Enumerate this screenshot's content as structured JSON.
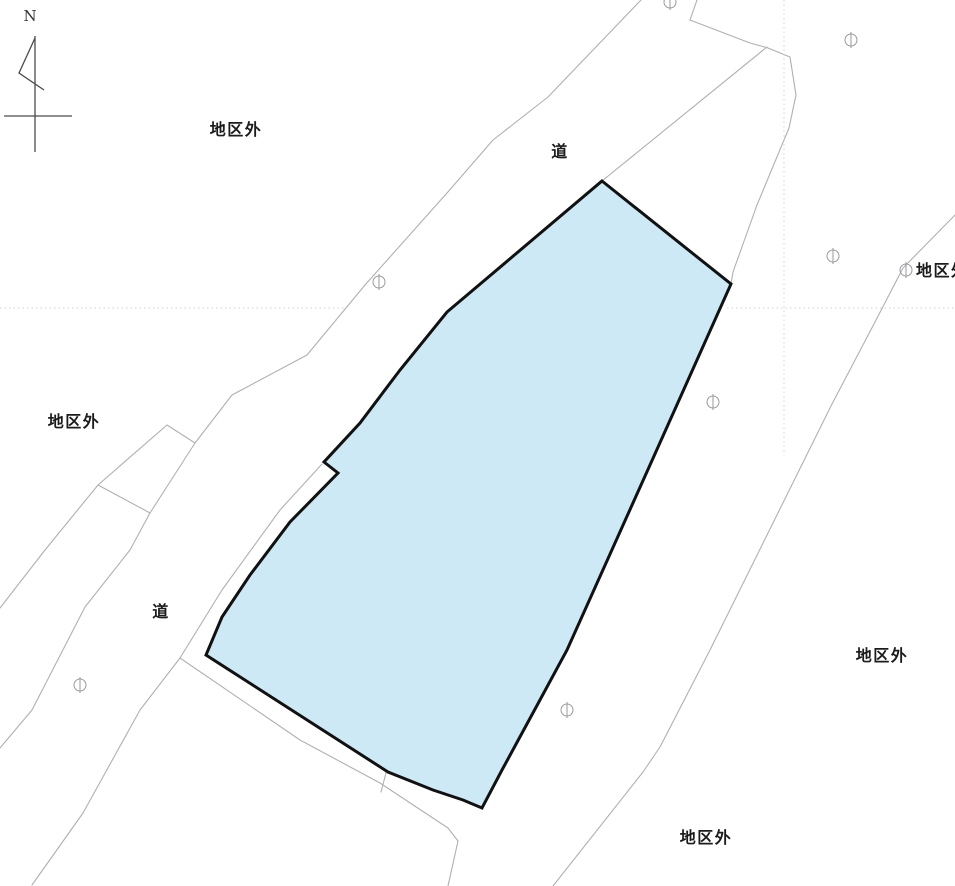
{
  "map": {
    "title": "cadastral district map",
    "north_label": "N",
    "labels": [
      {
        "text": "地区外",
        "x": 236,
        "y": 128,
        "anchor": "center"
      },
      {
        "text": "道",
        "x": 560,
        "y": 150,
        "anchor": "center"
      },
      {
        "text": "地区外",
        "x": 74,
        "y": 420,
        "anchor": "center"
      },
      {
        "text": "道",
        "x": 161,
        "y": 610,
        "anchor": "center"
      },
      {
        "text": "地区外",
        "x": 882,
        "y": 654,
        "anchor": "center"
      },
      {
        "text": "地区外",
        "x": 706,
        "y": 836,
        "anchor": "center"
      },
      {
        "text": "地区外",
        "x": 916,
        "y": 269,
        "anchor": "left"
      }
    ],
    "markers": {
      "symbol": "①",
      "color": "#9a9aa0",
      "points": [
        {
          "x": 670,
          "y": 2
        },
        {
          "x": 851,
          "y": 40
        },
        {
          "x": 833,
          "y": 256
        },
        {
          "x": 906,
          "y": 270
        },
        {
          "x": 379,
          "y": 282
        },
        {
          "x": 713,
          "y": 402
        },
        {
          "x": 80,
          "y": 685
        },
        {
          "x": 567,
          "y": 710
        }
      ]
    },
    "parcel": {
      "name": "highlighted district parcel",
      "fill": "#cde9f6",
      "stroke": "#111111",
      "stroke_width": 3,
      "points": [
        [
          602,
          181
        ],
        [
          731,
          284
        ],
        [
          650,
          465
        ],
        [
          567,
          650
        ],
        [
          534,
          711
        ],
        [
          502,
          770
        ],
        [
          482,
          808
        ],
        [
          463,
          800
        ],
        [
          433,
          790
        ],
        [
          388,
          772
        ],
        [
          206,
          655
        ],
        [
          222,
          617
        ],
        [
          250,
          575
        ],
        [
          290,
          522
        ],
        [
          338,
          473
        ],
        [
          324,
          462
        ],
        [
          360,
          423
        ],
        [
          400,
          370
        ],
        [
          447,
          312
        ]
      ]
    },
    "boundary_lines": {
      "color": "#b0b0b4",
      "solid": [
        [
          [
            641,
            0
          ],
          [
            548,
            97
          ],
          [
            493,
            140
          ],
          [
            447,
            193
          ],
          [
            365,
            285
          ],
          [
            307,
            355
          ],
          [
            232,
            395
          ],
          [
            195,
            443
          ],
          [
            150,
            513
          ],
          [
            130,
            550
          ],
          [
            85,
            607
          ],
          [
            32,
            710
          ],
          [
            0,
            748
          ]
        ],
        [
          [
            195,
            443
          ],
          [
            167,
            425
          ],
          [
            98,
            485
          ],
          [
            150,
            513
          ]
        ],
        [
          [
            98,
            485
          ],
          [
            45,
            550
          ],
          [
            0,
            608
          ]
        ],
        [
          [
            322,
            464
          ],
          [
            280,
            510
          ],
          [
            222,
            590
          ],
          [
            180,
            658
          ]
        ],
        [
          [
            180,
            658
          ],
          [
            140,
            710
          ],
          [
            83,
            813
          ],
          [
            32,
            885
          ]
        ],
        [
          [
            180,
            658
          ],
          [
            300,
            740
          ],
          [
            380,
            783
          ],
          [
            448,
            828
          ],
          [
            458,
            841
          ],
          [
            448,
            886
          ]
        ],
        [
          [
            386,
            773
          ],
          [
            381,
            792
          ]
        ],
        [
          [
            602,
            181
          ],
          [
            767,
            47
          ]
        ],
        [
          [
            697,
            0
          ],
          [
            690,
            20
          ],
          [
            750,
            43
          ],
          [
            768,
            48
          ]
        ],
        [
          [
            768,
            48
          ],
          [
            790,
            57
          ],
          [
            796,
            95
          ],
          [
            789,
            128
          ],
          [
            757,
            205
          ],
          [
            733,
            272
          ],
          [
            731,
            284
          ]
        ],
        [
          [
            955,
            215
          ],
          [
            903,
            268
          ],
          [
            875,
            322
          ],
          [
            832,
            404
          ],
          [
            710,
            650
          ],
          [
            660,
            747
          ],
          [
            643,
            772
          ],
          [
            553,
            886
          ]
        ]
      ],
      "dotted_color": "#c4c4c8",
      "dotted": [
        [
          [
            0,
            308
          ],
          [
            345,
            308
          ]
        ],
        [
          [
            727,
            308
          ],
          [
            955,
            308
          ]
        ],
        [
          [
            784,
            0
          ],
          [
            784,
            455
          ]
        ]
      ]
    },
    "compass": {
      "color": "#4a4a4a",
      "label_x": 30,
      "label_y": 16,
      "lines": [
        [
          [
            35,
            36
          ],
          [
            35,
            152
          ]
        ],
        [
          [
            4,
            116
          ],
          [
            72,
            116
          ]
        ],
        [
          [
            35,
            38
          ],
          [
            19,
            73
          ],
          [
            44,
            90
          ]
        ]
      ]
    }
  }
}
